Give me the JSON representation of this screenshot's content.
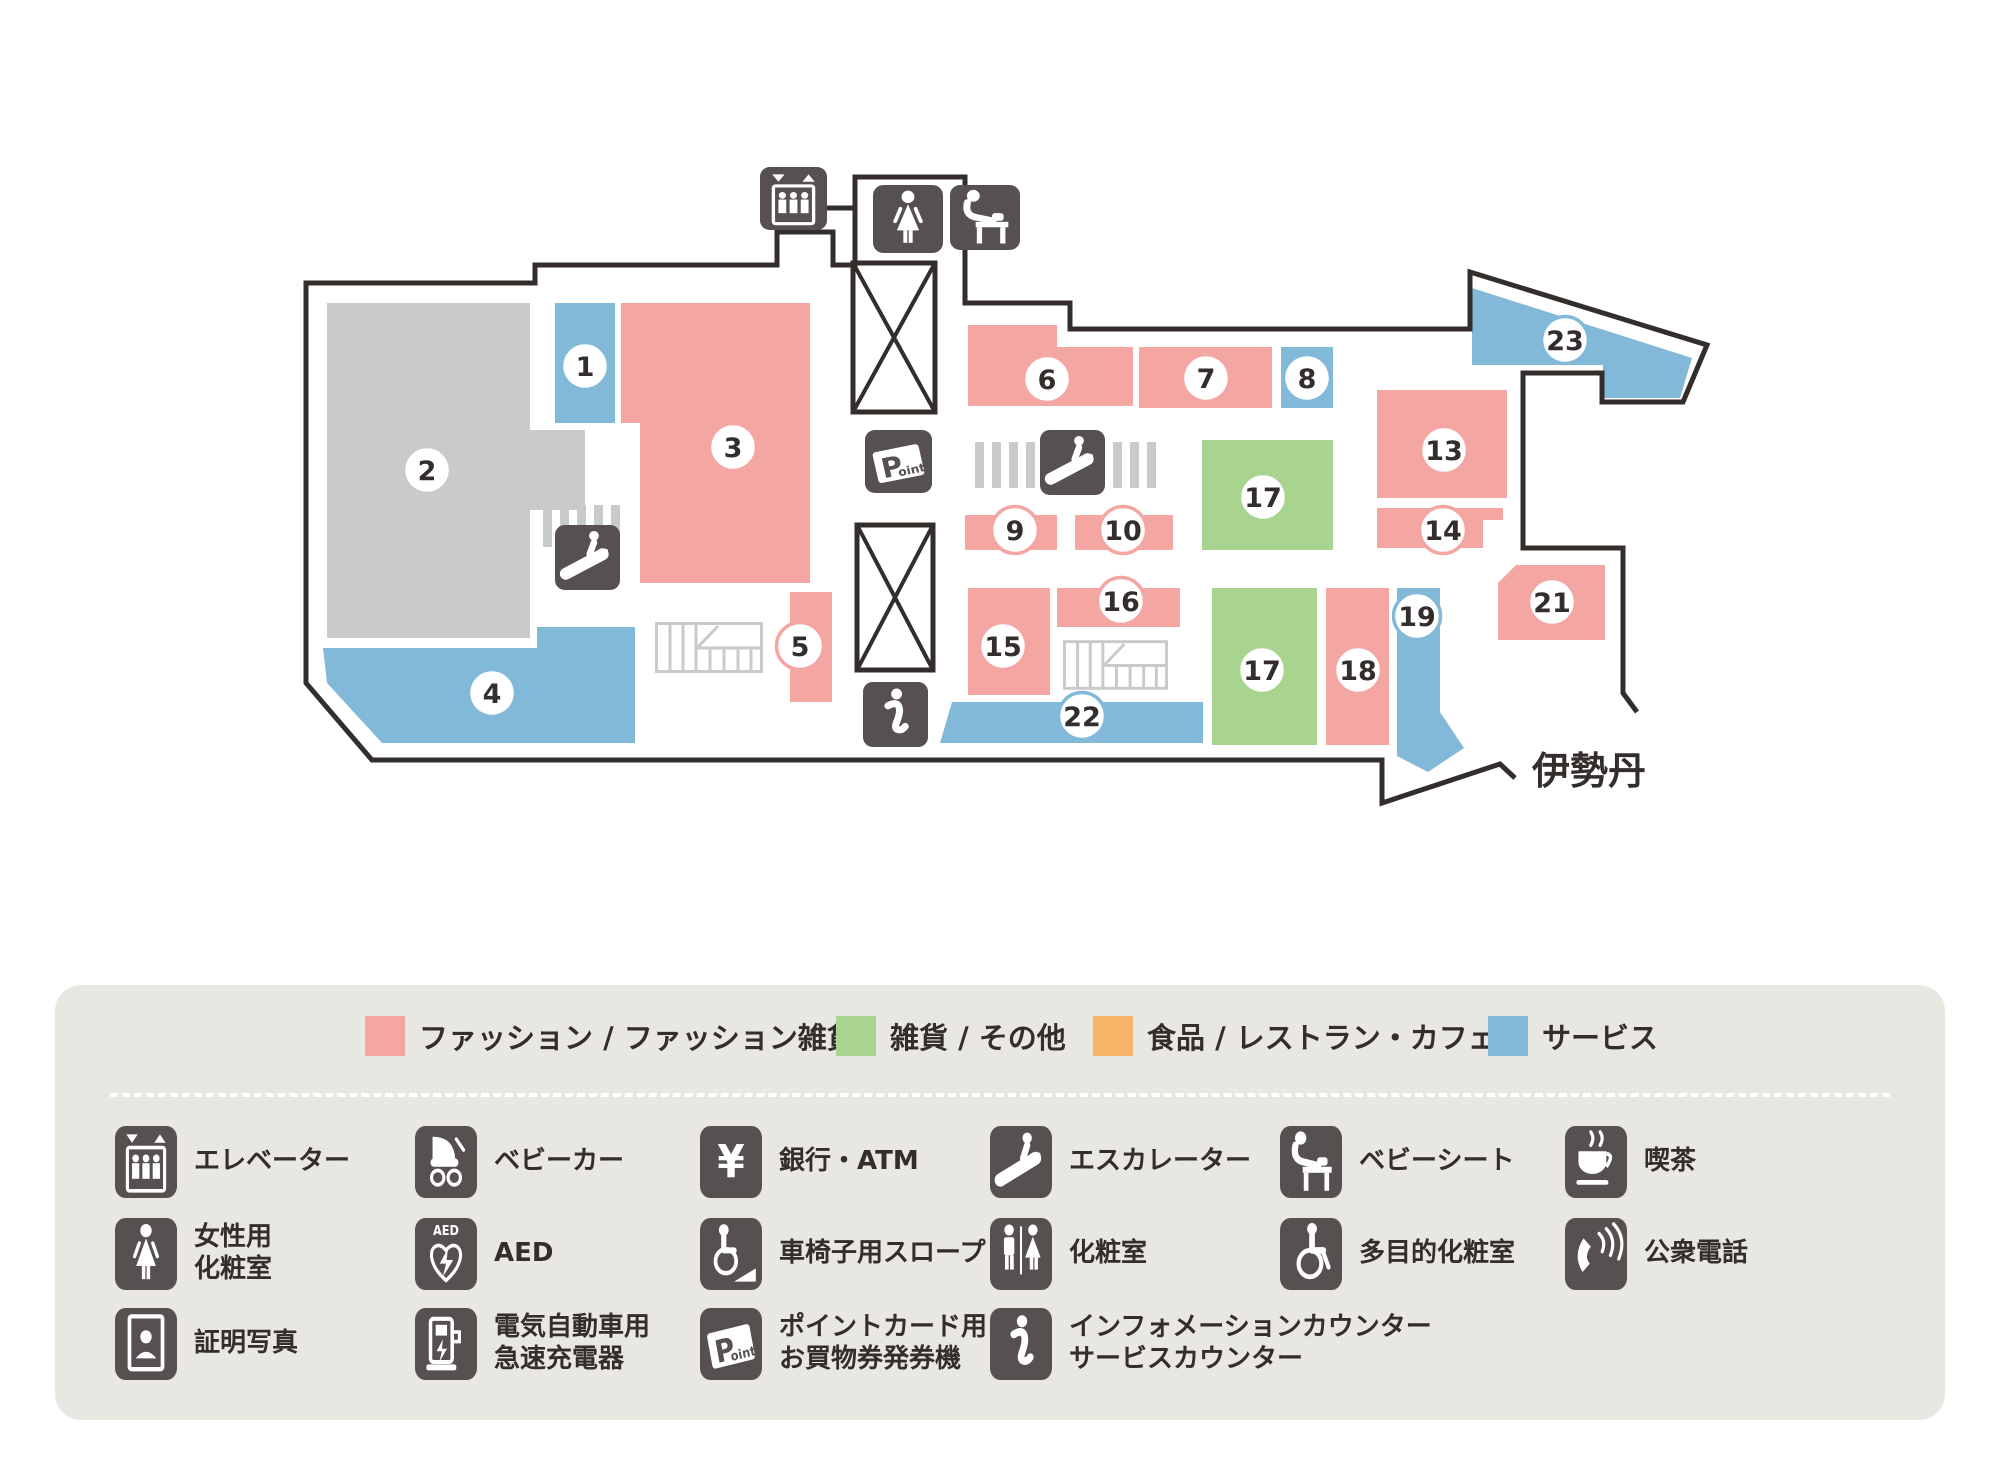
{
  "map": {
    "isetan_label": "伊勢丹",
    "colors": {
      "fashion": "#f3a6a2",
      "goods": "#a8d48f",
      "food": "#f5b468",
      "service": "#82b8d8",
      "anchor": "#c9cacb",
      "icon_dark": "#575050",
      "outline": "#332d2b",
      "stairs": "#c9cacb",
      "circle_fill": "#ffffff",
      "number_text": "#332d2b"
    },
    "rooms": [
      {
        "number": "1",
        "category": "service",
        "rect": [
          555,
          303,
          60,
          120
        ],
        "circle": [
          585,
          366
        ]
      },
      {
        "number": "2",
        "category": "anchor",
        "poly": [
          [
            327,
            303
          ],
          [
            530,
            303
          ],
          [
            530,
            430
          ],
          [
            585,
            430
          ],
          [
            585,
            510
          ],
          [
            530,
            510
          ],
          [
            530,
            638
          ],
          [
            327,
            638
          ]
        ],
        "circle": [
          427,
          470
        ]
      },
      {
        "number": "3",
        "category": "fashion",
        "poly": [
          [
            621,
            303
          ],
          [
            810,
            303
          ],
          [
            810,
            583
          ],
          [
            640,
            583
          ],
          [
            640,
            423
          ],
          [
            621,
            423
          ]
        ],
        "circle": [
          733,
          447
        ]
      },
      {
        "number": "4",
        "category": "service",
        "poly": [
          [
            323,
            648
          ],
          [
            537,
            648
          ],
          [
            537,
            627
          ],
          [
            635,
            627
          ],
          [
            635,
            743
          ],
          [
            382,
            743
          ],
          [
            327,
            683
          ]
        ],
        "circle": [
          492,
          693
        ]
      },
      {
        "number": "5",
        "category": "fashion",
        "rect": [
          790,
          592,
          42,
          110
        ],
        "circle": [
          800,
          646
        ]
      },
      {
        "number": "6",
        "category": "fashion",
        "poly": [
          [
            968,
            325
          ],
          [
            1057,
            325
          ],
          [
            1057,
            347
          ],
          [
            1133,
            347
          ],
          [
            1133,
            406
          ],
          [
            968,
            406
          ]
        ],
        "circle": [
          1047,
          379
        ]
      },
      {
        "number": "7",
        "category": "fashion",
        "rect": [
          1139,
          347,
          133,
          61
        ],
        "circle": [
          1206,
          378
        ]
      },
      {
        "number": "8",
        "category": "service",
        "rect": [
          1281,
          347,
          52,
          61
        ],
        "circle": [
          1307,
          378
        ]
      },
      {
        "number": "9",
        "category": "fashion",
        "rect": [
          965,
          515,
          92,
          35
        ],
        "circle": [
          1015,
          530
        ]
      },
      {
        "number": "10",
        "category": "fashion",
        "rect": [
          1075,
          515,
          98,
          35
        ],
        "circle": [
          1123,
          530
        ]
      },
      {
        "number": "13",
        "category": "fashion",
        "rect": [
          1377,
          390,
          130,
          108
        ],
        "circle": [
          1444,
          450
        ]
      },
      {
        "number": "14",
        "category": "fashion",
        "poly": [
          [
            1377,
            508
          ],
          [
            1503,
            508
          ],
          [
            1503,
            520
          ],
          [
            1483,
            520
          ],
          [
            1483,
            548
          ],
          [
            1377,
            548
          ]
        ],
        "circle": [
          1443,
          530
        ]
      },
      {
        "number": "15",
        "category": "fashion",
        "rect": [
          968,
          588,
          82,
          107
        ],
        "circle": [
          1003,
          646
        ]
      },
      {
        "number": "16",
        "category": "fashion",
        "rect": [
          1057,
          588,
          123,
          39
        ],
        "circle": [
          1121,
          601
        ]
      },
      {
        "number": "17",
        "category": "goods",
        "rect": [
          1202,
          440,
          131,
          110
        ],
        "circle": [
          1263,
          497
        ]
      },
      {
        "number": "17",
        "category": "goods",
        "rect": [
          1212,
          588,
          105,
          157
        ],
        "circle": [
          1262,
          670
        ]
      },
      {
        "number": "18",
        "category": "fashion",
        "rect": [
          1326,
          588,
          63,
          157
        ],
        "circle": [
          1358,
          670
        ]
      },
      {
        "number": "19",
        "category": "service",
        "poly": [
          [
            1397,
            588
          ],
          [
            1440,
            588
          ],
          [
            1440,
            712
          ],
          [
            1464,
            748
          ],
          [
            1428,
            772
          ],
          [
            1397,
            756
          ]
        ],
        "circle": [
          1417,
          616
        ]
      },
      {
        "number": "21",
        "category": "fashion",
        "poly": [
          [
            1516,
            565
          ],
          [
            1605,
            565
          ],
          [
            1605,
            640
          ],
          [
            1498,
            640
          ],
          [
            1498,
            583
          ]
        ],
        "circle": [
          1552,
          602
        ]
      },
      {
        "number": "22",
        "category": "service",
        "poly": [
          [
            952,
            702
          ],
          [
            1203,
            702
          ],
          [
            1203,
            743
          ],
          [
            940,
            743
          ]
        ],
        "circle": [
          1082,
          716
        ]
      },
      {
        "number": "23",
        "category": "service",
        "poly": [
          [
            1472,
            288
          ],
          [
            1692,
            358
          ],
          [
            1680,
            398
          ],
          [
            1603,
            398
          ],
          [
            1603,
            365
          ],
          [
            1472,
            365
          ]
        ],
        "circle": [
          1565,
          340
        ]
      }
    ],
    "facility_tiles": [
      {
        "icon": "elevator",
        "x": 760,
        "y": 167,
        "w": 67,
        "h": 63
      },
      {
        "icon": "woman",
        "x": 873,
        "y": 185,
        "w": 70,
        "h": 68
      },
      {
        "icon": "babyseat",
        "x": 950,
        "y": 185,
        "w": 70,
        "h": 65
      },
      {
        "icon": "point",
        "x": 865,
        "y": 430,
        "w": 67,
        "h": 63
      },
      {
        "icon": "escalator",
        "x": 1040,
        "y": 430,
        "w": 65,
        "h": 65
      },
      {
        "icon": "escalator",
        "x": 555,
        "y": 525,
        "w": 65,
        "h": 65
      },
      {
        "icon": "info",
        "x": 863,
        "y": 682,
        "w": 65,
        "h": 65
      }
    ]
  },
  "legend": {
    "categories": [
      {
        "label": "ファッション / ファッション雑貨",
        "color": "#f3a6a2"
      },
      {
        "label": "雑貨 / その他",
        "color": "#a8d48f"
      },
      {
        "label": "食品 / レストラン・カフェ",
        "color": "#f5b468"
      },
      {
        "label": "サービス",
        "color": "#82b8d8"
      }
    ],
    "facility_rows": [
      [
        {
          "icon": "elevator",
          "label": "エレベーター"
        },
        {
          "icon": "stroller",
          "label": "ベビーカー"
        },
        {
          "icon": "yen",
          "label": "銀行・ATM"
        },
        {
          "icon": "escalator",
          "label": "エスカレーター"
        },
        {
          "icon": "babyseat",
          "label": "ベビーシート"
        },
        {
          "icon": "coffee",
          "label": "喫茶"
        }
      ],
      [
        {
          "icon": "woman",
          "label": "女性用\n化粧室"
        },
        {
          "icon": "aed",
          "label": "AED"
        },
        {
          "icon": "ramp",
          "label": "車椅子用スロープ"
        },
        {
          "icon": "restroom",
          "label": "化粧室"
        },
        {
          "icon": "accessible",
          "label": "多目的化粧室"
        },
        {
          "icon": "phone",
          "label": "公衆電話"
        }
      ],
      [
        {
          "icon": "photo",
          "label": "証明写真"
        },
        {
          "icon": "ev",
          "label": "電気自動車用\n急速充電器"
        },
        {
          "icon": "point",
          "label": "ポイントカード用\nお買物券発券機"
        },
        {
          "icon": "info",
          "label": "インフォメーションカウンター\nサービスカウンター"
        }
      ]
    ]
  }
}
